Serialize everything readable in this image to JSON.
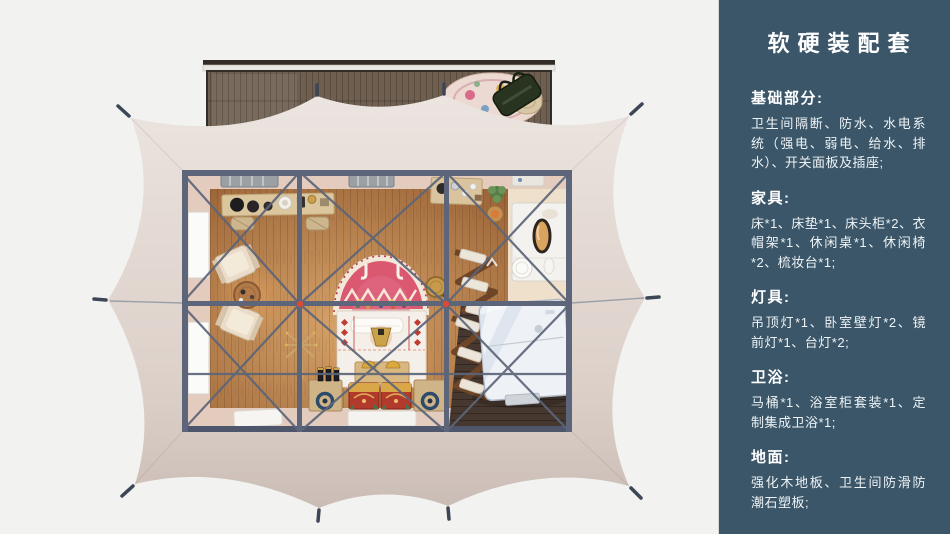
{
  "page": {
    "background": "#f2f2f0"
  },
  "panel": {
    "title": "软硬装配套",
    "bg_color": "#3a5668",
    "text_color": "#ffffff",
    "sections": [
      {
        "heading": "基础部分:",
        "body": "卫生间隔断、防水、水电系统（强电、弱电、给水、排水）、开关面板及插座;"
      },
      {
        "heading": "家具:",
        "body": "床*1、床垫*1、床头柜*2、衣帽架*1、休闲桌*1、休闲椅*2、梳妆台*1;"
      },
      {
        "heading": "灯具:",
        "body": "吊顶灯*1、卧室壁灯*2、镜前灯*1、台灯*2;"
      },
      {
        "heading": "卫浴:",
        "body": "马桶*1、浴室柜套装*1、定制集成卫浴*1;"
      },
      {
        "heading": "地面:",
        "body": "强化木地板、卫生间防滑防潮石塑板;"
      }
    ]
  },
  "floorplan": {
    "colors": {
      "tent_canvas": "#e0d4cd",
      "frame_beam": "#5c6579",
      "frame_beam_dark": "#4d566a",
      "interior_margin": "#e3ccbe",
      "bath_floor": "#46382f",
      "dressing_floor": "#eee0ca",
      "deck_frame": "#332c26",
      "joint_accent": "#d84a35",
      "stake": "#3c4656"
    }
  }
}
